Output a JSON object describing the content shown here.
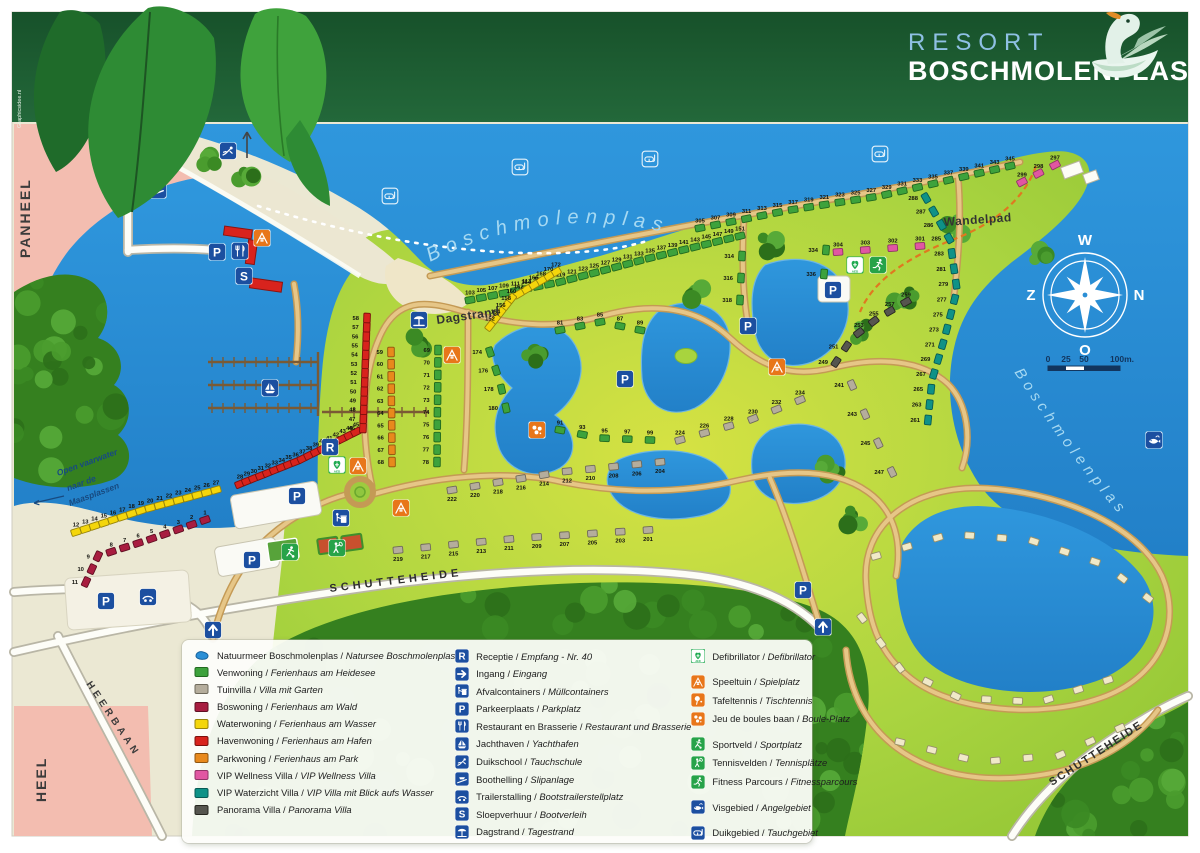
{
  "header": {
    "resort": "RESORT",
    "name": "BOSCHMOLENPLAS"
  },
  "credit": "Graphicsidee.nl",
  "water_labels": {
    "lake_top": "Boschmolenplas",
    "lake_right": "Boschmolenplas",
    "channel": [
      "Open vaarwater",
      "naar de",
      "Maasplassen"
    ]
  },
  "labels": [
    {
      "t": "PANHEEL",
      "x": 30,
      "y": 258,
      "r": -90,
      "s": 14,
      "w": 700,
      "c": "#3b3b3b",
      "ls": 2
    },
    {
      "t": "HEEL",
      "x": 46,
      "y": 802,
      "r": -90,
      "s": 14,
      "w": 700,
      "c": "#3b3b3b",
      "ls": 2
    },
    {
      "t": "HEERBAAN",
      "x": 86,
      "y": 684,
      "r": 56,
      "s": 10,
      "w": 700,
      "c": "#3b3b3b",
      "ls": 4
    },
    {
      "t": "SCHUTTEHEIDE",
      "x": 330,
      "y": 592,
      "r": -7,
      "s": 11,
      "w": 700,
      "c": "#2e2e2e",
      "ls": 4
    },
    {
      "t": "SCHUTTEHEIDE",
      "x": 1052,
      "y": 786,
      "r": -33,
      "s": 11,
      "w": 700,
      "c": "#2e2e2e",
      "ls": 2
    },
    {
      "t": "Wandelpad",
      "x": 944,
      "y": 226,
      "r": -4,
      "s": 12,
      "w": 700,
      "c": "#333333",
      "ls": 0.5
    },
    {
      "t": "Dagstrand",
      "x": 437,
      "y": 324,
      "r": -8,
      "s": 12,
      "w": 700,
      "c": "#333333",
      "ls": 0.5
    }
  ],
  "compass": {
    "top": "W",
    "right": "N",
    "bottom": "O",
    "left": "Z"
  },
  "scalebar": {
    "ticks": [
      "0",
      "25",
      "50",
      "100m."
    ]
  },
  "plot_types": {
    "venwoning": {
      "fill": "#3da23c",
      "stroke": "#21691f"
    },
    "tuinvilla": {
      "fill": "#b5ad9c",
      "stroke": "#6f6a5c"
    },
    "boswoning": {
      "fill": "#a81d40",
      "stroke": "#5f0f22"
    },
    "waterwoning": {
      "fill": "#f4d60b",
      "stroke": "#97840a"
    },
    "havenwoning": {
      "fill": "#d8231d",
      "stroke": "#7c100d"
    },
    "parkwoning": {
      "fill": "#e8891c",
      "stroke": "#8f540f"
    },
    "vip_wellness": {
      "fill": "#e156a2",
      "stroke": "#8f3466"
    },
    "vip_waterzicht": {
      "fill": "#0f9287",
      "stroke": "#075a54"
    },
    "panorama": {
      "fill": "#56554f",
      "stroke": "#26251f"
    },
    "chalet": {
      "fill": "#f0e9c8",
      "stroke": "#97906a"
    },
    "lake": {
      "fill": "#2b8fd6",
      "stroke": "#17629c"
    }
  },
  "clusters": [
    {
      "type": "boswoning",
      "path": [
        [
          205,
          520
        ],
        [
          148,
          540
        ],
        [
          98,
          556
        ],
        [
          86,
          582
        ]
      ],
      "numbers": [
        "1",
        "2",
        "3",
        "4",
        "5",
        "6",
        "7",
        "8",
        "9",
        "10",
        "11"
      ]
    },
    {
      "type": "waterwoning",
      "path": [
        [
          76,
          532
        ],
        [
          146,
          509
        ],
        [
          216,
          490
        ]
      ],
      "numbers": [
        "12",
        "13",
        "14",
        "15",
        "16",
        "17",
        "18",
        "19",
        "20",
        "21",
        "22",
        "23",
        "24",
        "25",
        "26",
        "27"
      ]
    },
    {
      "type": "havenwoning",
      "path": [
        [
          240,
          484
        ],
        [
          300,
          460
        ],
        [
          356,
          432
        ]
      ],
      "numbers": [
        "28",
        "29",
        "30",
        "31",
        "32",
        "33",
        "34",
        "35",
        "36",
        "37",
        "38",
        "39",
        "40",
        "41",
        "42",
        "43",
        "44",
        "45"
      ]
    },
    {
      "type": "havenwoning",
      "path": [
        [
          363,
          428
        ],
        [
          367,
          318
        ]
      ],
      "numbers": [
        "46",
        "47",
        "48",
        "49",
        "50",
        "51",
        "52",
        "53",
        "54",
        "55",
        "56",
        "57",
        "58"
      ]
    },
    {
      "type": "parkwoning",
      "path": [
        [
          391,
          352
        ],
        [
          392,
          462
        ]
      ],
      "numbers": [
        "59",
        "60",
        "61",
        "62",
        "63",
        "64",
        "65",
        "66",
        "67",
        "68"
      ]
    },
    {
      "type": "venwoning",
      "path": [
        [
          438,
          350
        ],
        [
          437,
          462
        ]
      ],
      "numbers": [
        "69",
        "70",
        "71",
        "72",
        "73",
        "74",
        "75",
        "76",
        "77",
        "78"
      ]
    },
    {
      "type": "venwoning",
      "path": [
        [
          470,
          300
        ],
        [
          560,
          282
        ],
        [
          650,
          258
        ],
        [
          740,
          236
        ]
      ],
      "numbers": [
        "103",
        "105",
        "107",
        "109",
        "111",
        "113",
        "115",
        "117",
        "119",
        "121",
        "123",
        "125",
        "127",
        "129",
        "131",
        "133",
        "135",
        "137",
        "139",
        "141",
        "143",
        "145",
        "147",
        "149",
        "151"
      ]
    },
    {
      "type": "waterwoning",
      "path": [
        [
          556,
          272
        ],
        [
          512,
          298
        ],
        [
          490,
          326
        ]
      ],
      "numbers": [
        "172",
        "170",
        "168",
        "166",
        "164",
        "162",
        "160",
        "158",
        "156",
        "154",
        "152"
      ]
    },
    {
      "type": "venwoning",
      "path": [
        [
          490,
          352
        ],
        [
          500,
          382
        ],
        [
          506,
          408
        ]
      ],
      "numbers": [
        "174",
        "176",
        "178",
        "180"
      ]
    },
    {
      "type": "venwoning",
      "path": [
        [
          560,
          330
        ],
        [
          600,
          322
        ],
        [
          640,
          330
        ]
      ],
      "numbers": [
        "81",
        "83",
        "85",
        "87",
        "89"
      ]
    },
    {
      "type": "venwoning",
      "path": [
        [
          560,
          430
        ],
        [
          600,
          438
        ],
        [
          650,
          440
        ]
      ],
      "numbers": [
        "91",
        "93",
        "95",
        "97",
        "99"
      ]
    },
    {
      "type": "tuinvilla",
      "nflip": true,
      "path": [
        [
          398,
          550
        ],
        [
          520,
          538
        ],
        [
          648,
          530
        ]
      ],
      "numbers": [
        "219",
        "217",
        "215",
        "213",
        "211",
        "209",
        "207",
        "205",
        "203",
        "201"
      ]
    },
    {
      "type": "tuinvilla",
      "nflip": true,
      "path": [
        [
          452,
          490
        ],
        [
          560,
          472
        ],
        [
          660,
          462
        ]
      ],
      "numbers": [
        "222",
        "220",
        "218",
        "216",
        "214",
        "212",
        "210",
        "208",
        "206",
        "204"
      ]
    },
    {
      "type": "tuinvilla",
      "path": [
        [
          680,
          440
        ],
        [
          750,
          420
        ],
        [
          800,
          400
        ]
      ],
      "numbers": [
        "224",
        "226",
        "228",
        "230",
        "232",
        "234"
      ]
    },
    {
      "type": "tuinvilla",
      "path": [
        [
          852,
          385
        ],
        [
          872,
          430
        ],
        [
          892,
          472
        ]
      ],
      "numbers": [
        "241",
        "243",
        "245",
        "247"
      ]
    },
    {
      "type": "panorama",
      "path": [
        [
          906,
          302
        ],
        [
          878,
          318
        ],
        [
          852,
          338
        ],
        [
          836,
          362
        ]
      ],
      "numbers": [
        "259",
        "257",
        "255",
        "253",
        "251",
        "249"
      ]
    },
    {
      "type": "vip_waterzicht",
      "path": [
        [
          926,
          198
        ],
        [
          950,
          240
        ],
        [
          957,
          290
        ],
        [
          944,
          340
        ],
        [
          932,
          380
        ],
        [
          928,
          420
        ]
      ],
      "numbers": [
        "288",
        "287",
        "286",
        "285",
        "283",
        "281",
        "279",
        "277",
        "275",
        "273",
        "271",
        "269",
        "267",
        "265",
        "263",
        "261"
      ]
    },
    {
      "type": "vip_wellness",
      "path": [
        [
          838,
          252
        ],
        [
          920,
          246
        ]
      ],
      "numbers": [
        "304",
        "303",
        "302",
        "301"
      ]
    },
    {
      "type": "vip_wellness",
      "path": [
        [
          1022,
          182
        ],
        [
          1055,
          165
        ]
      ],
      "numbers": [
        "299",
        "298",
        "297"
      ]
    },
    {
      "type": "venwoning",
      "path": [
        [
          700,
          228
        ],
        [
          790,
          210
        ],
        [
          880,
          196
        ],
        [
          1010,
          166
        ]
      ],
      "numbers": [
        "305",
        "307",
        "309",
        "311",
        "313",
        "315",
        "317",
        "319",
        "321",
        "323",
        "325",
        "327",
        "329",
        "331",
        "333",
        "335",
        "337",
        "339",
        "341",
        "343",
        "345"
      ]
    },
    {
      "type": "venwoning",
      "path": [
        [
          742,
          256
        ],
        [
          740,
          300
        ]
      ],
      "numbers": [
        "314",
        "316",
        "318"
      ]
    },
    {
      "type": "venwoning",
      "path": [
        [
          826,
          250
        ],
        [
          824,
          274
        ]
      ],
      "numbers": [
        "334",
        "336"
      ]
    },
    {
      "type": "chalet",
      "count": 10,
      "path": [
        [
          876,
          556
        ],
        [
          950,
          534
        ],
        [
          1030,
          540
        ],
        [
          1105,
          565
        ],
        [
          1148,
          598
        ]
      ]
    },
    {
      "type": "chalet",
      "count": 10,
      "path": [
        [
          862,
          618
        ],
        [
          900,
          668
        ],
        [
          960,
          698
        ],
        [
          1040,
          702
        ],
        [
          1108,
          680
        ]
      ]
    },
    {
      "type": "chalet",
      "count": 8,
      "path": [
        [
          900,
          742
        ],
        [
          980,
          762
        ],
        [
          1060,
          755
        ],
        [
          1120,
          728
        ]
      ]
    }
  ],
  "icons": [
    {
      "n": "slipway",
      "x": 158,
      "y": 190
    },
    {
      "n": "diver",
      "x": 228,
      "y": 151
    },
    {
      "n": "parking",
      "x": 217,
      "y": 252
    },
    {
      "n": "restaurant",
      "x": 240,
      "y": 251
    },
    {
      "n": "rental",
      "x": 244,
      "y": 276
    },
    {
      "n": "playground",
      "x": 262,
      "y": 238
    },
    {
      "n": "sailboat",
      "x": 270,
      "y": 388
    },
    {
      "n": "beach",
      "x": 419,
      "y": 320
    },
    {
      "n": "reception",
      "x": 330,
      "y": 447
    },
    {
      "n": "aed",
      "x": 337,
      "y": 465
    },
    {
      "n": "parking",
      "x": 297,
      "y": 496
    },
    {
      "n": "trash",
      "x": 341,
      "y": 518
    },
    {
      "n": "playground",
      "x": 358,
      "y": 466
    },
    {
      "n": "playground",
      "x": 401,
      "y": 508
    },
    {
      "n": "playground",
      "x": 452,
      "y": 355
    },
    {
      "n": "boules",
      "x": 537,
      "y": 430
    },
    {
      "n": "sport",
      "x": 290,
      "y": 552
    },
    {
      "n": "tennis",
      "x": 337,
      "y": 548
    },
    {
      "n": "parking",
      "x": 252,
      "y": 560
    },
    {
      "n": "parking",
      "x": 106,
      "y": 601
    },
    {
      "n": "trailer",
      "x": 148,
      "y": 597
    },
    {
      "n": "entrance",
      "x": 213,
      "y": 630
    },
    {
      "n": "entrance",
      "x": 823,
      "y": 627
    },
    {
      "n": "parking",
      "x": 833,
      "y": 290
    },
    {
      "n": "aed",
      "x": 855,
      "y": 265
    },
    {
      "n": "fitness",
      "x": 878,
      "y": 265
    },
    {
      "n": "parking",
      "x": 748,
      "y": 326
    },
    {
      "n": "parking",
      "x": 625,
      "y": 379
    },
    {
      "n": "parking",
      "x": 803,
      "y": 590
    },
    {
      "n": "playground",
      "x": 777,
      "y": 367
    },
    {
      "n": "maskoutline",
      "x": 390,
      "y": 196
    },
    {
      "n": "maskoutline",
      "x": 520,
      "y": 167
    },
    {
      "n": "maskoutline",
      "x": 650,
      "y": 159
    },
    {
      "n": "maskoutline",
      "x": 880,
      "y": 154
    },
    {
      "n": "fish",
      "x": 1154,
      "y": 440
    }
  ],
  "legend": {
    "columns": [
      [
        {
          "swatch": "lake",
          "nl": "Natuurmeer Boschmolenplas",
          "de": "Natursee Boschmolenplas"
        },
        {
          "swatch": "venwoning",
          "nl": "Venwoning",
          "de": "Ferienhaus am Heidesee"
        },
        {
          "swatch": "tuinvilla",
          "nl": "Tuinvilla",
          "de": "Villa mit Garten"
        },
        {
          "swatch": "boswoning",
          "nl": "Boswoning",
          "de": "Ferienhaus am Wald"
        },
        {
          "swatch": "waterwoning",
          "nl": "Waterwoning",
          "de": "Ferienhaus am Wasser"
        },
        {
          "swatch": "havenwoning",
          "nl": "Havenwoning",
          "de": "Ferienhaus am Hafen"
        },
        {
          "swatch": "parkwoning",
          "nl": "Parkwoning",
          "de": "Ferienhaus am Park"
        },
        {
          "swatch": "vip_wellness",
          "nl": "VIP Wellness Villa",
          "de": "VIP Wellness Villa"
        },
        {
          "swatch": "vip_waterzicht",
          "nl": "VIP Waterzicht Villa",
          "de": "VIP Villa mit Blick aufs Wasser"
        },
        {
          "swatch": "panorama",
          "nl": "Panorama Villa",
          "de": "Panorama Villa"
        }
      ],
      [
        {
          "icon": "reception",
          "nl": "Receptie",
          "de": "Empfang - Nr. 40"
        },
        {
          "icon": "arrow",
          "nl": "Ingang",
          "de": "Eingang"
        },
        {
          "icon": "trash",
          "nl": "Afvalcontainers",
          "de": "Müllcontainers"
        },
        {
          "icon": "parking",
          "nl": "Parkeerplaats",
          "de": "Parkplatz"
        },
        {
          "icon": "restaurant",
          "nl": "Restaurant en Brasserie",
          "de": "Restaurant und Brasserie"
        },
        {
          "icon": "sailboat",
          "nl": "Jachthaven",
          "de": "Yachthafen"
        },
        {
          "icon": "diver",
          "nl": "Duikschool",
          "de": "Tauchschule"
        },
        {
          "icon": "slipway",
          "nl": "Boothelling",
          "de": "Slipanlage"
        },
        {
          "icon": "trailer",
          "nl": "Trailerstalling",
          "de": "Bootstrailerstellplatz"
        },
        {
          "icon": "rental",
          "nl": "Sloepverhuur",
          "de": "Bootverleih"
        },
        {
          "icon": "beach",
          "nl": "Dagstrand",
          "de": "Tagestrand"
        }
      ],
      [
        {
          "icon": "aed",
          "nl": "Defibrillator",
          "de": "Defibrillator"
        },
        {
          "icon": "playground",
          "nl": "Speeltuin",
          "de": "Spielplatz",
          "gap": true
        },
        {
          "icon": "tabletennis",
          "nl": "Tafeltennis",
          "de": "Tischtennis"
        },
        {
          "icon": "boules",
          "nl": "Jeu de boules baan",
          "de": "Boule-Platz"
        },
        {
          "icon": "sport",
          "nl": "Sportveld",
          "de": "Sportplatz",
          "gap": true
        },
        {
          "icon": "tennis",
          "nl": "Tennisvelden",
          "de": "Tennisplätze"
        },
        {
          "icon": "fitness",
          "nl": "Fitness Parcours",
          "de": "Fitnessparcours"
        },
        {
          "icon": "fish",
          "nl": "Visgebied",
          "de": "Angelgebiet",
          "gap": true
        },
        {
          "icon": "maskarea",
          "nl": "Duikgebied",
          "de": "Tauchgebiet",
          "gap": true
        }
      ]
    ]
  }
}
